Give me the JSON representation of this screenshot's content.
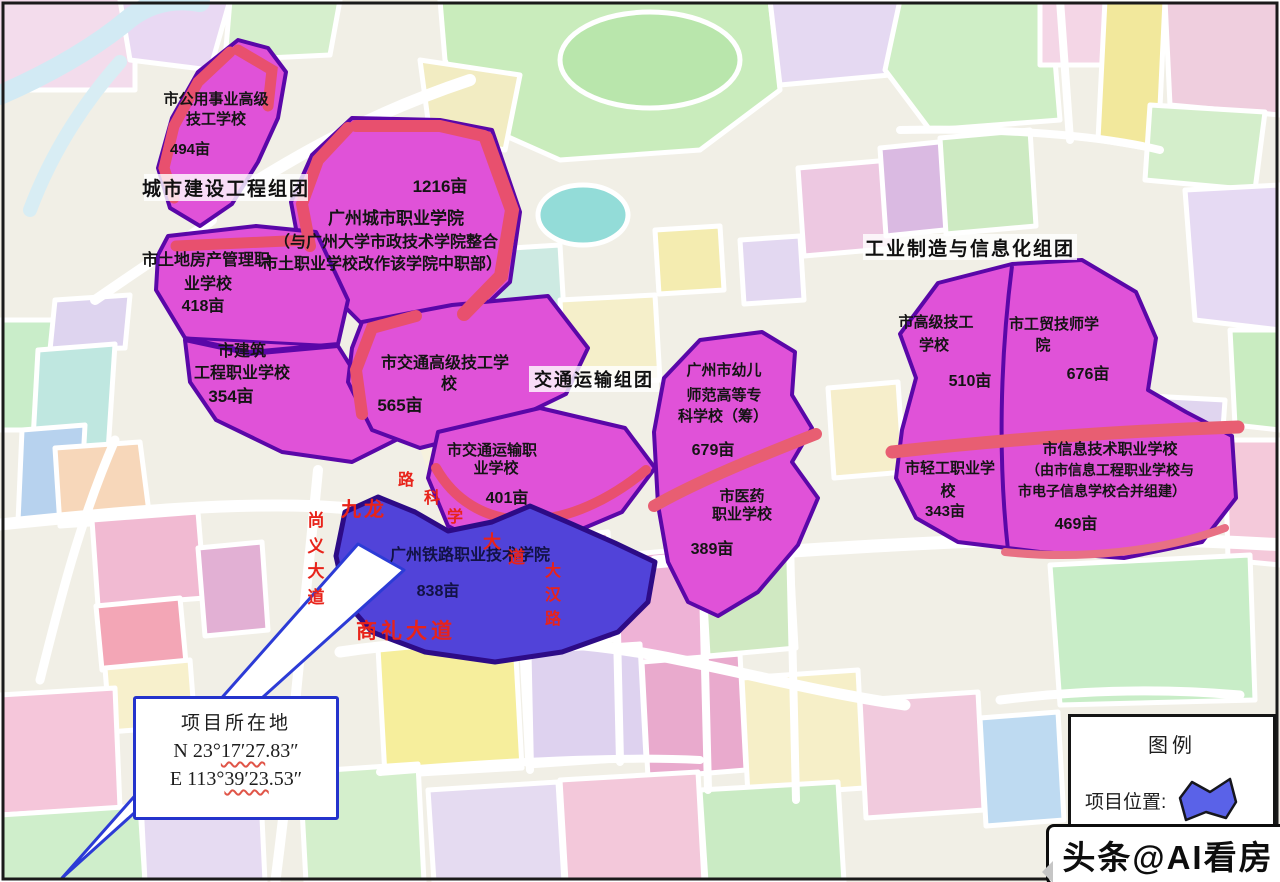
{
  "groups": {
    "g1": "城市建设工程组团",
    "g2": "交通运输组团",
    "g3": "工业制造与信息化组团"
  },
  "parcels": {
    "public_utility": {
      "lines": [
        "市公用事业高级",
        "技工学校"
      ],
      "area": "494亩"
    },
    "city_college": {
      "area": "1216亩",
      "name": "广州城市职业学院",
      "notes": [
        "（与广州大学市政技术学院整合",
        "市土职业学校改作该学院中职部）"
      ]
    },
    "land_housing": {
      "lines": [
        "市土地房产管理职",
        "业学校"
      ],
      "area": "418亩"
    },
    "construction": {
      "lines": [
        "市建筑",
        "工程职业学校"
      ],
      "area": "354亩"
    },
    "transport_senior": {
      "lines": [
        "市交通高级技工学",
        "校"
      ],
      "area": "565亩"
    },
    "transport_vocational": {
      "lines": [
        "市交通运输职",
        "业学校"
      ],
      "area": "401亩"
    },
    "railway": {
      "name": "广州铁路职业技术学院",
      "area": "838亩"
    },
    "preschool": {
      "lines": [
        "广州市幼儿",
        "师范高等专",
        "科学校（筹）"
      ],
      "area": "679亩"
    },
    "medicine": {
      "lines": [
        "市医药",
        "职业学校"
      ],
      "area": "389亩"
    },
    "senior_tech": {
      "lines": [
        "市高级技工",
        "学校"
      ],
      "area": "510亩"
    },
    "trade_tech": {
      "lines": [
        "市工贸技师学",
        "院"
      ],
      "area": "676亩"
    },
    "light_industry": {
      "lines": [
        "市轻工职业学",
        "校"
      ],
      "area": "343亩"
    },
    "info_tech": {
      "lines": [
        "市信息技术职业学校",
        "（由市信息工程职业学校与",
        "市电子信息学校合并组建）"
      ],
      "area": "469亩"
    }
  },
  "roads": {
    "shangli_avenue": "商礼大道",
    "jiulong": "九龙",
    "left_vertical": [
      "尚",
      "义",
      "大",
      "道"
    ],
    "diagonal": [
      "路",
      "科",
      "学",
      "大",
      "道"
    ],
    "right_vertical": [
      "大",
      "汉",
      "路"
    ]
  },
  "callout": {
    "title": "项目所在地",
    "lat_prefix": "N 23°",
    "lat_mid": "17′27",
    "lat_suffix": ".83″",
    "lng_prefix": "E 113°",
    "lng_mid": "39′23",
    "lng_suffix": ".53″"
  },
  "legend": {
    "title": "图例",
    "item_label": "项目位置:",
    "item_icon": "project-area-polygon"
  },
  "watermark": "头条@AI看房",
  "colors": {
    "parcel_magenta": "#e052d8",
    "project_blue": "#5143d9",
    "parcel_border": "#5a07a8",
    "accent_red": "#e8506e",
    "road_label_red": "#e8231a"
  }
}
